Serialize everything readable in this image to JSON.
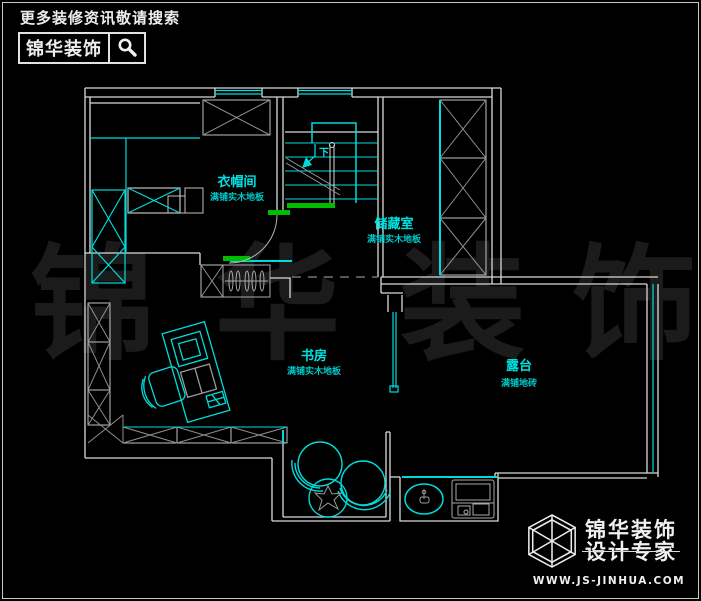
{
  "header": {
    "tagline": "更多装修资讯敬请搜索",
    "brand": "锦华装饰"
  },
  "watermark": {
    "chars": [
      "锦",
      "华",
      "装",
      "饰"
    ]
  },
  "rooms": [
    {
      "name": "衣帽间",
      "floor": "满铺实木地板"
    },
    {
      "name": "储藏室",
      "floor": "满铺实木地板"
    },
    {
      "name": "书房",
      "floor": "满铺实木地板"
    },
    {
      "name": "露台",
      "floor": "满铺地砖"
    }
  ],
  "stairs": {
    "down_label": "下"
  },
  "footer": {
    "brand_line1": "锦华装饰",
    "brand_line2": "设计专家",
    "website": "WWW.JS-JINHUA.COM"
  },
  "icons": {
    "search": "magnifier-icon",
    "logo": "cube-wireframe-icon"
  },
  "colors": {
    "background": "#000000",
    "wall": "#d9d9d9",
    "furniture": "#00dcdc",
    "threshold_green": "#00bc00",
    "watermark": "#1b1b1b"
  }
}
